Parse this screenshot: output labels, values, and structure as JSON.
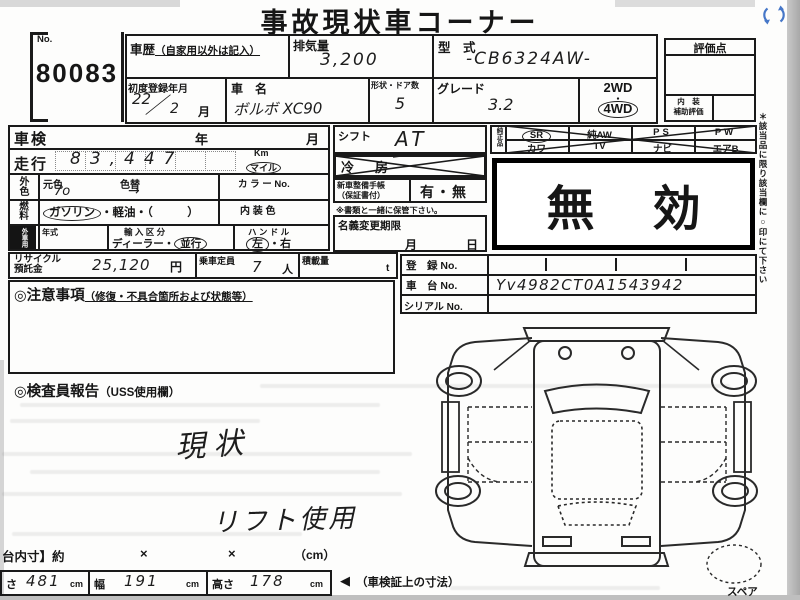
{
  "title": "事故現状車コーナー",
  "no_box": {
    "label": "No.",
    "value": "80083"
  },
  "header": {
    "history_label": "車歴",
    "history_note": "（自家用以外は記入）",
    "displacement_label": "排気量",
    "displacement_value": "3,200",
    "model_label": "型　式",
    "model_value": "-CB6324AW-",
    "first_reg_label": "初度登録年月",
    "first_reg_year": "22",
    "first_reg_slash": "／",
    "first_reg_month": "2",
    "first_reg_unit": "月",
    "name_label": "車　名",
    "name_value": "ボルボ XC90",
    "shape_label": "形状・ドア数",
    "shape_value": "5",
    "grade_label": "グレード",
    "grade_value": "3.2",
    "wd2": "2WD",
    "wd_dot": "・",
    "wd4": "4WD"
  },
  "rating": {
    "title": "評価点",
    "interior_line1": "内　装",
    "interior_line2": "補助評価"
  },
  "left_table": {
    "shaken_label": "車検",
    "year_label": "年",
    "month_label": "月",
    "mileage_label": "走行",
    "mileage_value": "83,447",
    "km_label": "Km",
    "mile_label": "マイル",
    "color_side": "外色",
    "base_color_label": "元色",
    "base_color_value": "7o",
    "repaint_label": "色替",
    "repaint_value": "→",
    "color_no_label": "カ ラ ー No.",
    "fuel_side": "燃料",
    "fuel_gasoline": "ガソリン",
    "fuel_rest": "・軽油・（　　　）",
    "interior_color_label": "内 装 色",
    "import_side": "外車用",
    "year2_label": "年式",
    "import_label": "輸 入 区 分",
    "import_dealer": "ディーラー",
    "import_dot": "・",
    "import_parallel": "並行",
    "handle_label": "ハ ン ド ル",
    "handle_left": "左",
    "handle_dot": "・",
    "handle_right": "右"
  },
  "mid": {
    "shift_label": "シフト",
    "shift_value": "AT",
    "aircon_label": "冷　房",
    "book_line1": "新車整備手帳",
    "book_line2": "（保証書付）",
    "book_value": "有・無",
    "keep_note": "※書類と一緒に保管下さい。",
    "transfer_label": "名義変更期限",
    "transfer_month": "月",
    "transfer_day": "日"
  },
  "parts": {
    "side_label": "純正品",
    "row1": [
      "SR",
      "純AW",
      "PS",
      "PW"
    ],
    "row2": [
      "カワ",
      "TV",
      "ナビ",
      "エアB"
    ]
  },
  "invalid": {
    "char1": "無",
    "char2": "効"
  },
  "right_note": "＊該当品に限り該当欄に○印にて下さい",
  "recycle": {
    "label_line1": "リサイクル",
    "label_line2": "預託金",
    "value": "25,120",
    "unit": "円",
    "capacity_label": "乗車定員",
    "capacity_value": "7",
    "capacity_unit": "人",
    "load_label": "積載量",
    "load_unit": "t"
  },
  "registration": {
    "reg_label": "登　録 No.",
    "chassis_label": "車　台 No.",
    "chassis_value": "Yv4982CT0A1543942",
    "serial_label": "シリアル No."
  },
  "caution": {
    "title": "◎注意事項",
    "subtitle": "（修復・不具合箇所および状態等）"
  },
  "inspector": {
    "title": "◎検査員報告",
    "subtitle": "（USS使用欄）"
  },
  "handwriting": {
    "note1": "現状",
    "note2": "リフト使用"
  },
  "dimensions": {
    "row_label": "台内寸】約",
    "x1": "×",
    "x2": "×",
    "unit": "（cm）",
    "length_label": "さ",
    "length_value": "481",
    "length_unit": "cm",
    "width_label": "幅",
    "width_value": "191",
    "width_unit": "cm",
    "height_label": "高さ",
    "height_value": "178",
    "height_unit": "cm",
    "arrow": "◀",
    "arrow_note": "（車検証上の寸法）"
  },
  "spare_label": "スペア"
}
